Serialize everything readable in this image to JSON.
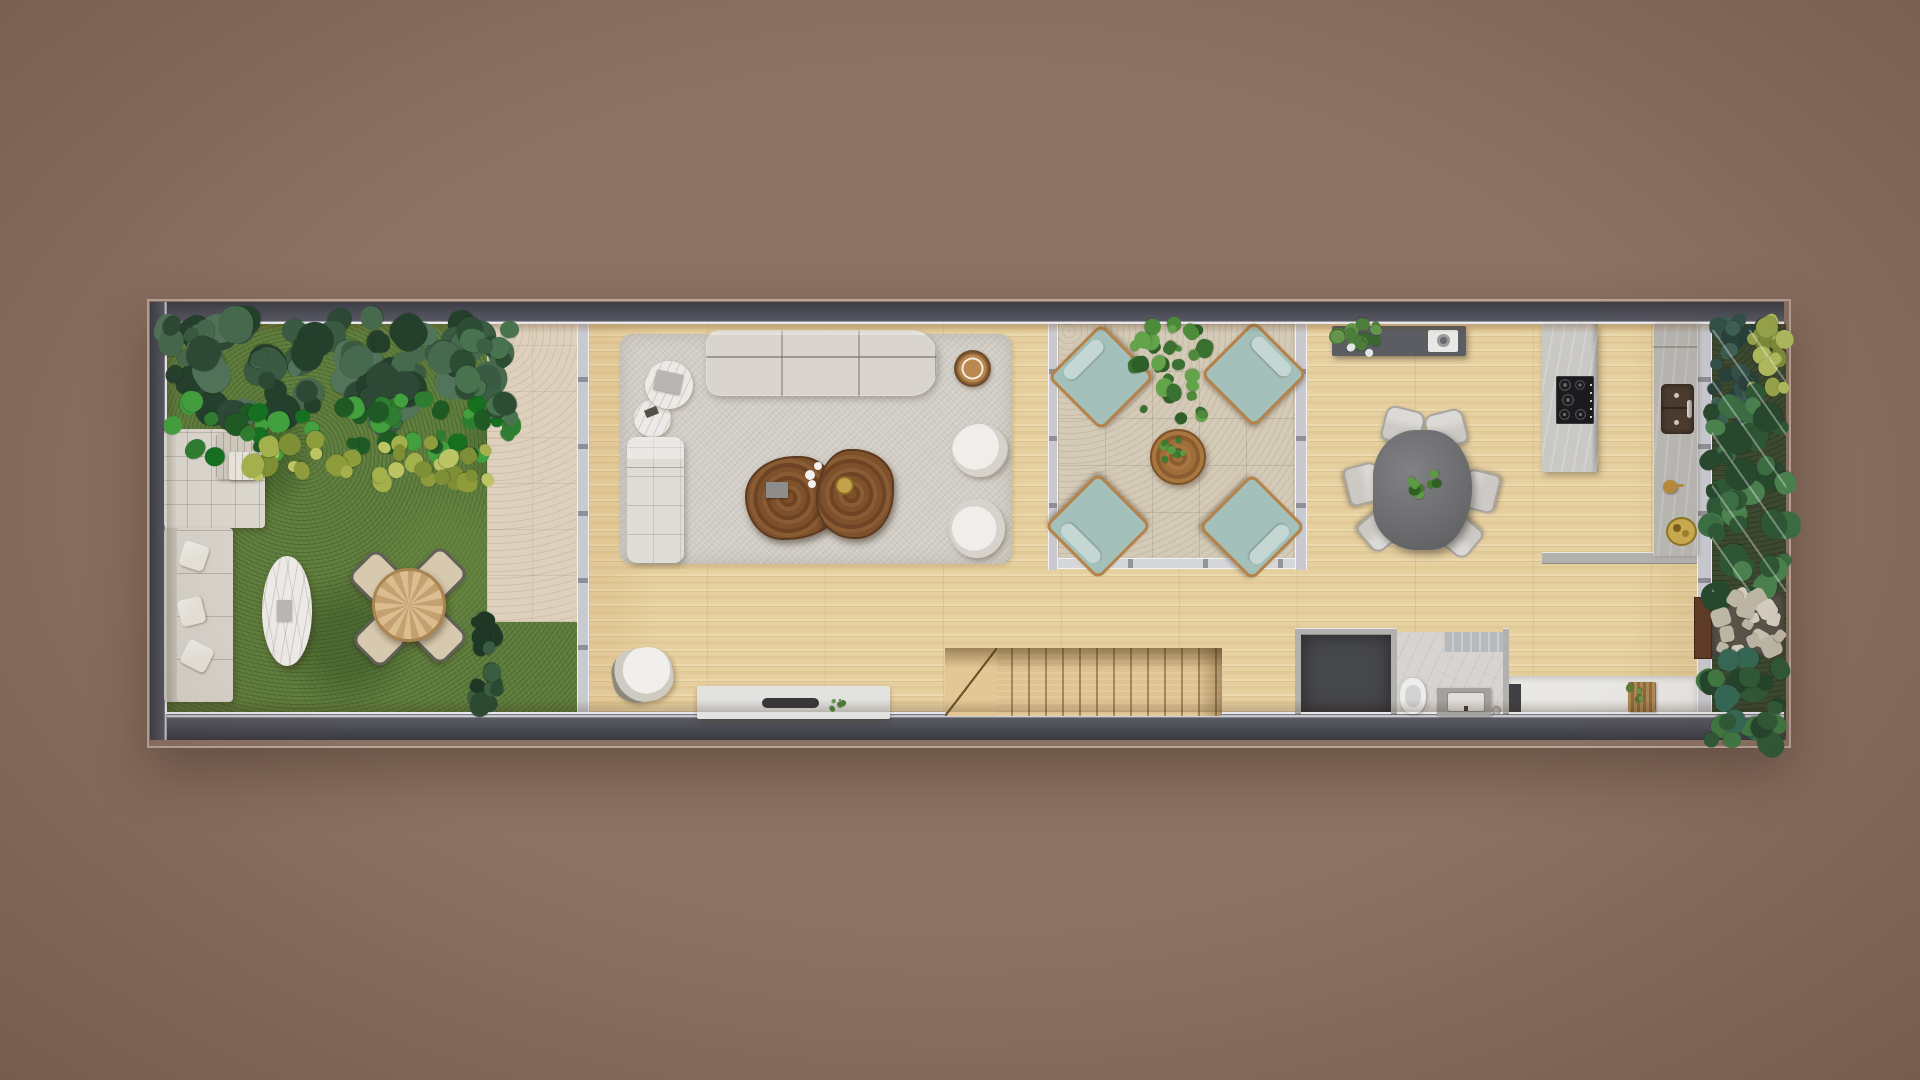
{
  "meta": {
    "title": "Top-down architectural floor plan rendering",
    "style": "photoreal 3D top view, narrow lot house, no text labels visible"
  },
  "palette": {
    "background": "#8c7263",
    "frame_dark": "#45454e",
    "inner_line": "#e9e9ed",
    "lawn": "#5e7c3d",
    "travertine_path": "#ddd1be",
    "courtyard_tile": "#d4cab8",
    "wood_floor": "#e6d0a0",
    "side_garden_base": "#3c4a31",
    "stone_path_base": "#5a544b",
    "rug": "#d2cec7",
    "sofa": "#d9d5ce",
    "daybed": "#dbd7cf",
    "garden_sofa": "#d8d4cc",
    "pillow": "#e8e4db",
    "marble": "#eceae6",
    "garden_chair_seat": "#d7c9ad",
    "chaise": "#dfdcd5",
    "wood_slab_table": "#7a4e2a",
    "stool_wood": "#b9854e",
    "armchair_shell": "#8f8b84",
    "accent_chair_shell": "#8e877c",
    "tv_console": "#e2e2e0",
    "soundbar": "#38383a",
    "teal_cushion": "#a3c0bb",
    "teal_roll": "#c4d7d2",
    "chair_wood_frame": "#b5834a",
    "court_table_wood": "#9a6a38",
    "dining_table": "#6f7073",
    "dining_chair": "#cdcac5",
    "sideboard": "#5b5d62",
    "sideboard_tray": "#e8e8e6",
    "island": "#c9c8c4",
    "cooktop": "#1b1b1e",
    "counter": "#b7b5b0",
    "sink_basin": "#4a3b2e",
    "brass": "#b5893c",
    "gold_tray": "#c9a94e",
    "stairs_wood": "#dfc291",
    "dark_room_floor": "#46474b",
    "bathroom_floor": "#d8d5d1",
    "shower_marble": "#b7babc",
    "toilet": "#eceded",
    "vanity": "#a3a19d",
    "vanity_sink": "#dfdedb",
    "entry_floor": "#e9e8e5",
    "entry_cabinet": "#3f4044",
    "gate_brown": "#5f3c26",
    "book": "#b8b6b2",
    "decor_box": "#8e8d8b",
    "dish_white": "#f2f1ee",
    "gold_bowl": "#c2a14a",
    "blanket": "#cfc9bd"
  },
  "scene": {
    "zones": [
      {
        "id": "backyard-garden",
        "label": "backyard garden with lawn and planting bed"
      },
      {
        "id": "garden-path",
        "label": "travertine garden path"
      },
      {
        "id": "living-room",
        "label": "living room on light wood floor"
      },
      {
        "id": "winter-garden-patio",
        "label": "internal patio with travertine tiles"
      },
      {
        "id": "dining-kitchen",
        "label": "dining area and kitchen"
      },
      {
        "id": "staircase",
        "label": "wooden staircase"
      },
      {
        "id": "storage-room",
        "label": "dark floored storage room"
      },
      {
        "id": "bathroom",
        "label": "bathroom with toilet and vanity"
      },
      {
        "id": "entry-strip",
        "label": "entry strip with doormat"
      },
      {
        "id": "side-garden",
        "label": "side garden with stone path and gate"
      }
    ],
    "furniture": [
      {
        "id": "garden-daybed",
        "label": "outdoor daybed with folded blanket"
      },
      {
        "id": "garden-sofa",
        "label": "outdoor sofa with pillows"
      },
      {
        "id": "garden-oval-table",
        "label": "oval marble coffee table"
      },
      {
        "id": "garden-dining-table",
        "label": "round wooden table with 4 chairs"
      },
      {
        "id": "living-sofa",
        "label": "three seat sofa"
      },
      {
        "id": "side-tables",
        "label": "two round marble side tables with books"
      },
      {
        "id": "chaise-lounge",
        "label": "upholstered chaise lounge"
      },
      {
        "id": "slab-coffee-table",
        "label": "live edge wood slab coffee table with decor"
      },
      {
        "id": "wood-stool",
        "label": "round wooden stool"
      },
      {
        "id": "swivel-armchairs",
        "label": "two white swivel armchairs"
      },
      {
        "id": "accent-chair",
        "label": "accent chair near media wall"
      },
      {
        "id": "tv-console",
        "label": "low media console with soundbar"
      },
      {
        "id": "patio-lounge-chairs",
        "label": "four teal wood-frame lounge chairs"
      },
      {
        "id": "patio-coffee-table",
        "label": "round wooden patio table with plant"
      },
      {
        "id": "dining-sideboard",
        "label": "dark sideboard with plant and tray"
      },
      {
        "id": "dining-table",
        "label": "organic shaped dark dining table, 6 chairs"
      },
      {
        "id": "kitchen-island",
        "label": "island peninsula with 5-burner gas cooktop"
      },
      {
        "id": "kitchen-counter",
        "label": "counter with double basin sink and brassware"
      },
      {
        "id": "doormat",
        "label": "slatted wooden doormat with plant"
      }
    ]
  },
  "foliage_zones": [
    {
      "name": "backyard-canopy",
      "x": 167,
      "y": 318,
      "w": 336,
      "h": 102,
      "colors": [
        "#3a5a42",
        "#2d4936",
        "#476a4e",
        "#24402d",
        "#52745a"
      ],
      "count": 85,
      "rmin": 8,
      "rmax": 19,
      "seed": 11
    },
    {
      "name": "backyard-ferns",
      "x": 167,
      "y": 400,
      "w": 345,
      "h": 58,
      "colors": [
        "#2f7d31",
        "#1f5a24",
        "#43a03e",
        "#157020"
      ],
      "count": 50,
      "rmin": 5,
      "rmax": 12,
      "seed": 22
    },
    {
      "name": "backyard-grasses",
      "x": 252,
      "y": 438,
      "w": 258,
      "h": 46,
      "colors": [
        "#a4b04c",
        "#8f9c3c",
        "#bcc464",
        "#7f8f35"
      ],
      "count": 36,
      "rmin": 5,
      "rmax": 11,
      "seed": 33
    },
    {
      "name": "path-top-plant",
      "x": 462,
      "y": 322,
      "w": 50,
      "h": 98,
      "colors": [
        "#3a5f42",
        "#2c4c34",
        "#48734e"
      ],
      "count": 18,
      "rmin": 7,
      "rmax": 14,
      "seed": 44
    },
    {
      "name": "path-edge-hedge",
      "x": 477,
      "y": 612,
      "w": 20,
      "h": 102,
      "colors": [
        "#2c4a32",
        "#1f3826",
        "#3a5c40"
      ],
      "count": 18,
      "rmin": 6,
      "rmax": 11,
      "seed": 55
    },
    {
      "name": "patio-plant",
      "x": 1134,
      "y": 324,
      "w": 80,
      "h": 94,
      "colors": [
        "#4d8a39",
        "#3a7030",
        "#63a349",
        "#2f5f28"
      ],
      "count": 34,
      "rmin": 4,
      "rmax": 10,
      "seed": 66
    },
    {
      "name": "patio-table-plant",
      "x": 1163,
      "y": 440,
      "w": 28,
      "h": 28,
      "colors": [
        "#3f7a31",
        "#5a9a43"
      ],
      "count": 8,
      "rmin": 2,
      "rmax": 5,
      "seed": 77
    },
    {
      "name": "sideboard-plant",
      "x": 1334,
      "y": 324,
      "w": 44,
      "h": 40,
      "colors": [
        "#4d7d3a",
        "#3a6630",
        "#63964b",
        "#dfe8df"
      ],
      "count": 16,
      "rmin": 3,
      "rmax": 8,
      "seed": 88
    },
    {
      "name": "dining-centerpiece",
      "x": 1406,
      "y": 467,
      "w": 31,
      "h": 31,
      "colors": [
        "#447c2f",
        "#5d9a43",
        "#2f5f22"
      ],
      "count": 10,
      "rmin": 3,
      "rmax": 6,
      "seed": 99
    },
    {
      "name": "side-garden-teal-shrubs",
      "x": 1712,
      "y": 320,
      "w": 52,
      "h": 108,
      "colors": [
        "#33524a",
        "#28423b",
        "#3e6156"
      ],
      "count": 26,
      "rmin": 6,
      "rmax": 12,
      "seed": 101
    },
    {
      "name": "side-garden-grasses",
      "x": 1746,
      "y": 320,
      "w": 40,
      "h": 72,
      "colors": [
        "#9aa84c",
        "#b3bf60",
        "#7f8f3a"
      ],
      "count": 20,
      "rmin": 5,
      "rmax": 10,
      "seed": 112
    },
    {
      "name": "side-garden-monstera",
      "x": 1708,
      "y": 388,
      "w": 80,
      "h": 212,
      "colors": [
        "#3c6f44",
        "#2e5836",
        "#4c8450",
        "#27492f"
      ],
      "count": 46,
      "rmin": 7,
      "rmax": 15,
      "seed": 123
    },
    {
      "name": "stone-path-stones",
      "x": 1714,
      "y": 594,
      "w": 68,
      "h": 60,
      "colors": [
        "#cfc8b8",
        "#dad3c4",
        "#c2bbaa"
      ],
      "count": 16,
      "rmin": 5,
      "rmax": 10,
      "seed": 134,
      "shape": "stone"
    },
    {
      "name": "side-garden-lower",
      "x": 1708,
      "y": 650,
      "w": 80,
      "h": 94,
      "colors": [
        "#2f5a38",
        "#417a43",
        "#24452c",
        "#356a57"
      ],
      "count": 30,
      "rmin": 7,
      "rmax": 13,
      "seed": 145
    },
    {
      "name": "entry-doormat-plant",
      "x": 1627,
      "y": 685,
      "w": 16,
      "h": 16,
      "colors": [
        "#5d7a36",
        "#72924a"
      ],
      "count": 6,
      "rmin": 2,
      "rmax": 4,
      "seed": 156
    },
    {
      "name": "console-plant",
      "x": 831,
      "y": 699,
      "w": 12,
      "h": 13,
      "colors": [
        "#4c7a35",
        "#659a48"
      ],
      "count": 5,
      "rmin": 1,
      "rmax": 3,
      "seed": 167
    }
  ]
}
